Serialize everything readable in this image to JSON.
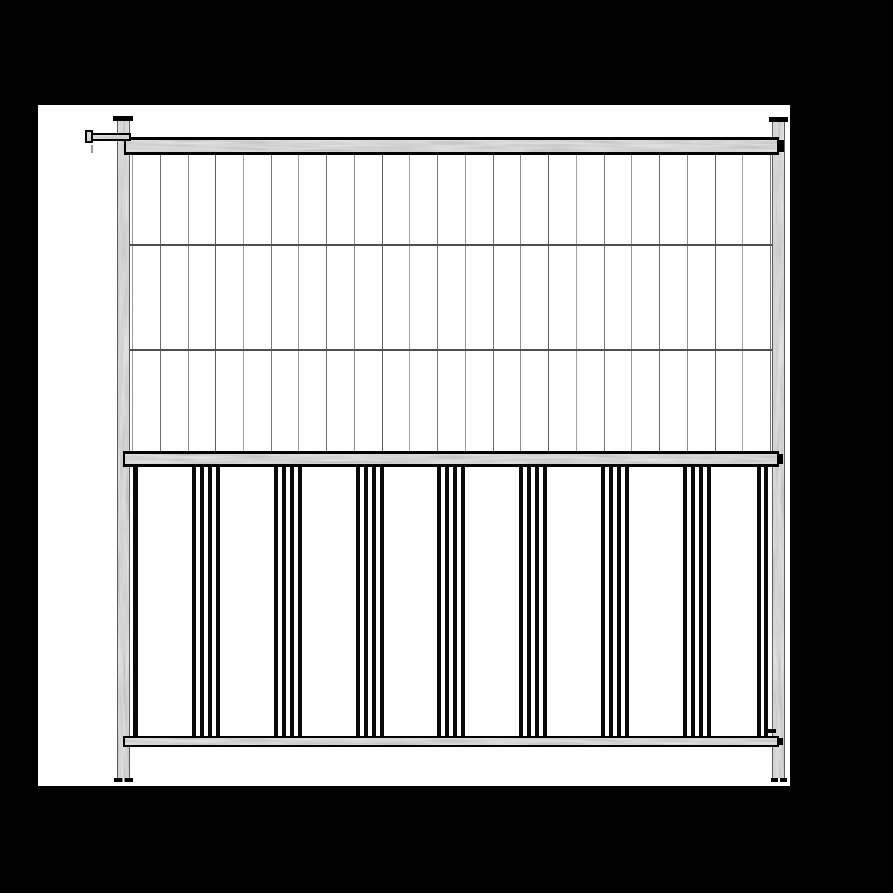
{
  "scene": {
    "background_color": "#000000",
    "canvas_color": "#ffffff",
    "canvas": {
      "x": 38,
      "y": 105,
      "w": 752,
      "h": 681
    }
  },
  "palette": {
    "outline": "#000000",
    "bar": "#0a0a0a",
    "galvanized_base": "#a8a8a8",
    "mesh_cross": "#4f4f4f",
    "mesh_shades": [
      "#9b9b9b",
      "#6f6f6f",
      "#8d8d8d",
      "#5e5e5e",
      "#a3a3a3",
      "#7a7a7a"
    ]
  },
  "panel": {
    "posts": {
      "left": {
        "x": 117,
        "y": 120,
        "w": 13,
        "h": 661
      },
      "right": {
        "x": 772,
        "y": 122,
        "w": 13,
        "h": 659
      },
      "left_cap": {
        "x": 113,
        "y": 116,
        "w": 20,
        "h": 5
      },
      "right_cap": {
        "x": 769,
        "y": 117,
        "w": 19,
        "h": 5
      },
      "left_foot": {
        "x": 114,
        "y": 778,
        "w": 19,
        "h": 4
      },
      "right_foot": {
        "x": 771,
        "y": 778,
        "w": 16,
        "h": 4
      }
    },
    "rails": {
      "top": {
        "x": 124,
        "y": 137,
        "w": 655,
        "h": 18
      },
      "middle": {
        "x": 123,
        "y": 451,
        "w": 656,
        "h": 16
      },
      "bottom": {
        "x": 123,
        "y": 736,
        "w": 656,
        "h": 11
      }
    },
    "slots": [
      {
        "x": 779,
        "y": 140,
        "w": 5,
        "h": 12
      },
      {
        "x": 777,
        "y": 454,
        "w": 6,
        "h": 10
      },
      {
        "x": 777,
        "y": 738,
        "w": 6,
        "h": 7
      }
    ],
    "mesh": {
      "x0": 132,
      "x1": 770,
      "y0": 155,
      "y1": 451,
      "vertical_count": 24,
      "cross_y": [
        244,
        349
      ],
      "cross_x0": 129,
      "cross_x1": 772
    },
    "bars": {
      "y0": 467,
      "y1": 736,
      "width": 4,
      "left_single_x": 133,
      "left_single_w": 5,
      "right_pair_x": [
        757,
        764
      ],
      "group_centers": [
        206,
        288,
        370,
        451,
        533,
        615,
        697
      ],
      "group_offsets": [
        -14,
        -6,
        2,
        10
      ]
    },
    "latch": {
      "arm": {
        "x": 87,
        "y": 133,
        "w": 44,
        "h": 8
      },
      "lug": {
        "x": 85,
        "y": 130,
        "w": 8,
        "h": 13
      },
      "drip": {
        "x": 91,
        "y": 145,
        "w": 2,
        "h": 8
      }
    },
    "bracket_tab": {
      "x": 768,
      "y": 729,
      "w": 8,
      "h": 4
    }
  }
}
